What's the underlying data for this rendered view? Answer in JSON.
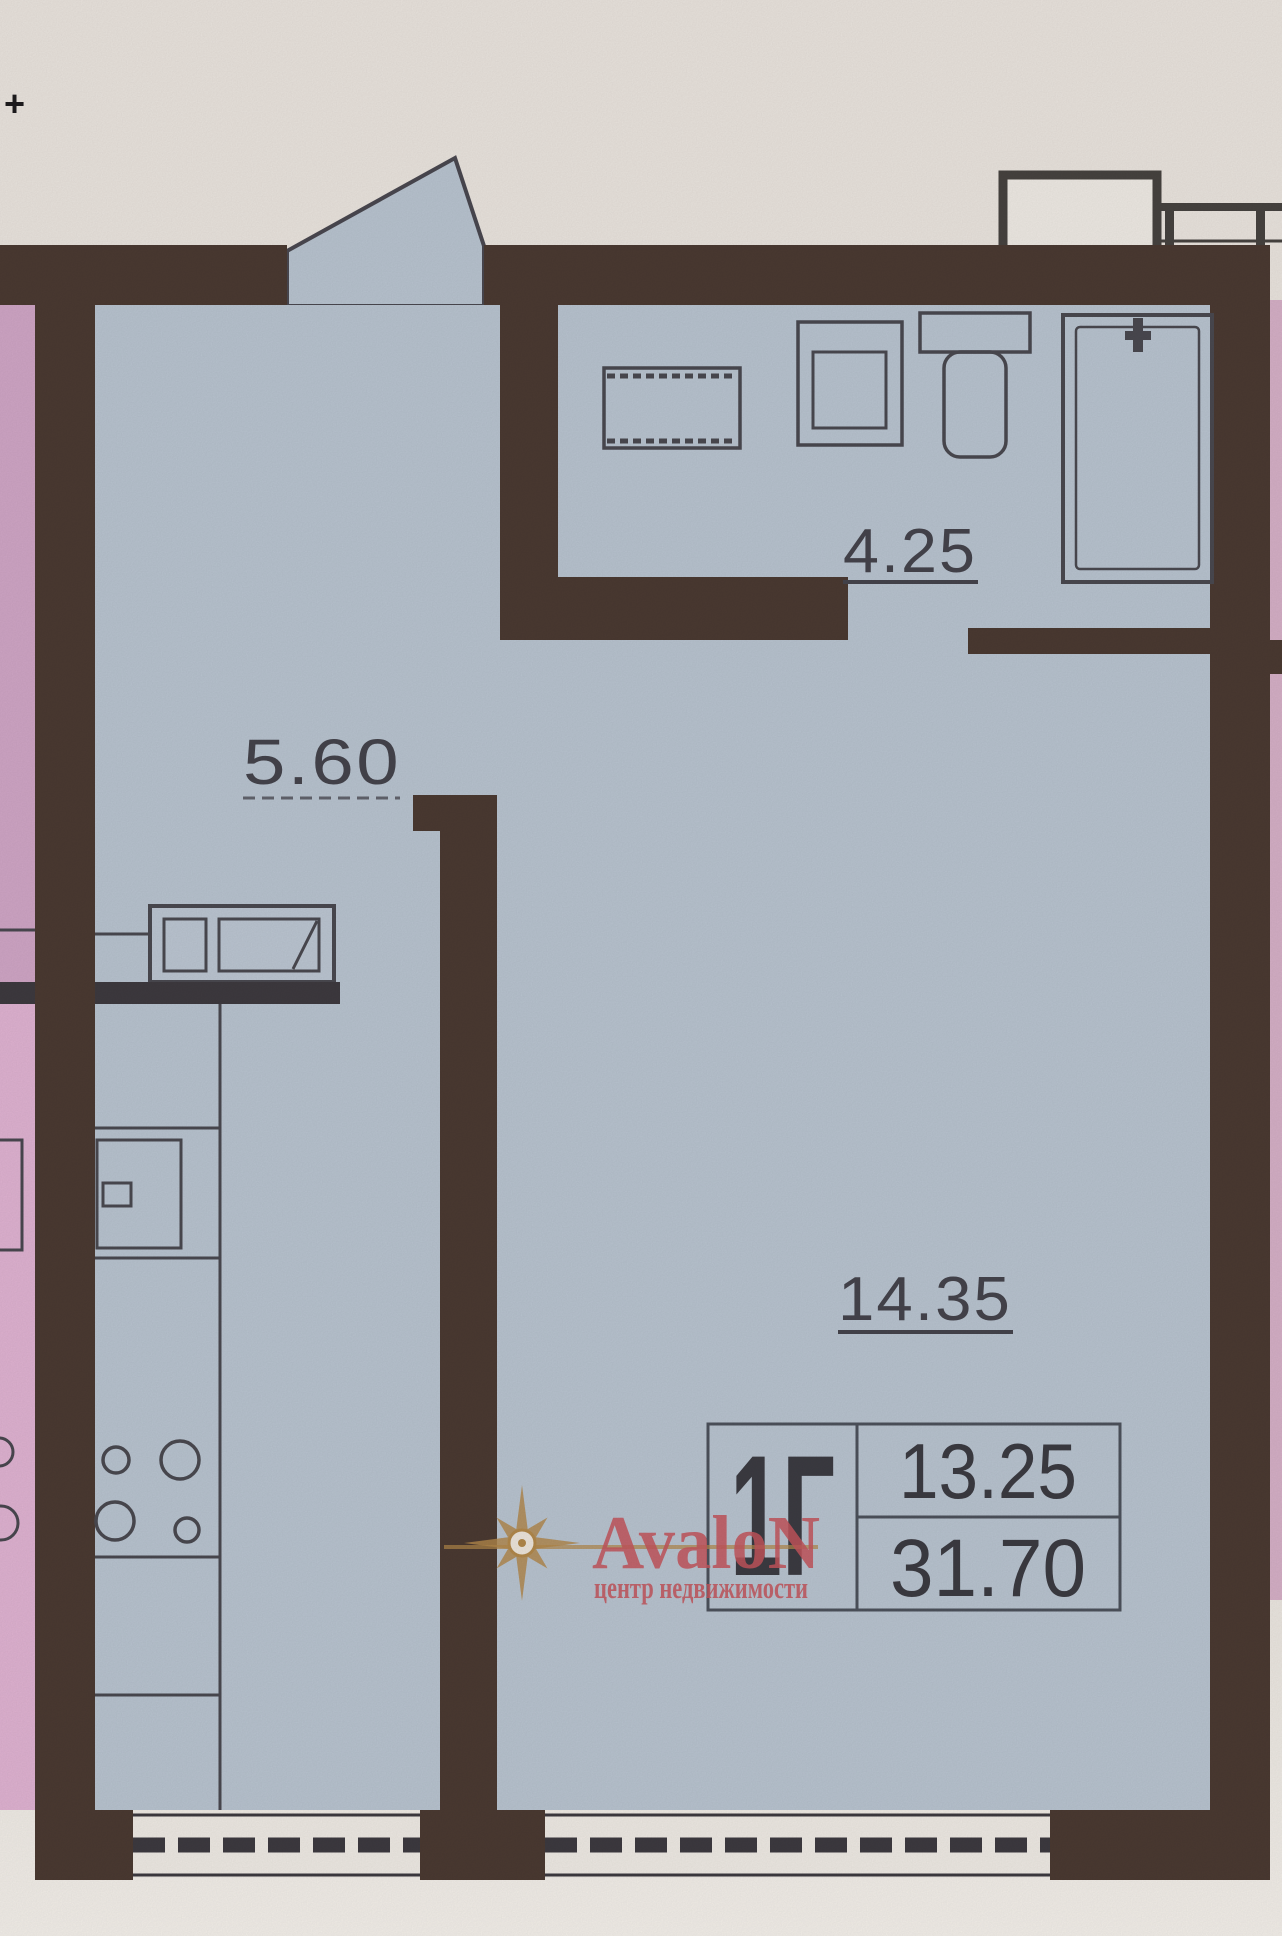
{
  "plan": {
    "registration_mark": "+",
    "rooms": [
      {
        "id": "bathroom",
        "area_label": "4.25"
      },
      {
        "id": "kitchen-hall",
        "area_label": "5.60"
      },
      {
        "id": "living-room",
        "area_label": "14.35"
      }
    ],
    "stamp": {
      "unit_type": "1Г",
      "living_area": "13.25",
      "total_area": "31.70"
    }
  },
  "watermark": {
    "brand": "AvaloN",
    "tagline": "центр недвижимости",
    "accent_red": "#c4555c",
    "accent_gold": "#b2884a"
  },
  "palette": {
    "wall_brown": "#4b3a32",
    "floor_blue": "#b9c4d0",
    "neighbor_pink_upper": "#d0a6c6",
    "neighbor_pink_lower": "#e0b3d2",
    "neighbor_pink_right": "#d6b0c7",
    "paper_cream": "#ece7e1",
    "ink_line": "#4a4950",
    "label_text": "#45444c"
  }
}
